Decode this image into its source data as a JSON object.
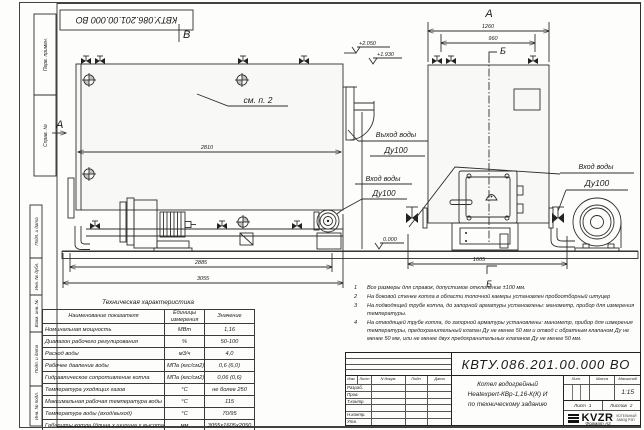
{
  "colors": {
    "line": "#2e2e2e",
    "paper": "#fdfdfc",
    "fill": "#f8f8f6"
  },
  "sheet": {
    "stamp_top": "КВТУ.086.201.00.000  ВО",
    "format_label": "Формат",
    "format_value": "А3",
    "margin": {
      "perv_primen": "Перв. примен.",
      "sprav_no": "Справ. №",
      "podp_data_1": "Подп. и дата",
      "inv_dubl": "Инв. № дубл.",
      "vzam_inv": "Взам. инв. №",
      "podp_data_2": "Подп. и дата",
      "inv_podl": "Инв. № подл."
    }
  },
  "views": {
    "side": {
      "label_b": "В",
      "label_a": "А",
      "see_note": "см. п. 2",
      "dim_width": "2810",
      "dim_frame": "2885",
      "dim_total": "3055",
      "outlet_line1": "Выход воды",
      "outlet_line2": "Ду100",
      "inlet_line1": "Вход воды",
      "inlet_line2": "Ду100"
    },
    "front": {
      "view_title": "А",
      "dim_total_width": "1260",
      "dim_valves": "960",
      "section_top": "Б",
      "section_bottom": "Б",
      "dim_base": "1605",
      "inlet_line1": "Вход воды",
      "inlet_line2": "Ду100"
    },
    "elevations": {
      "top": "+2.050",
      "mid": "+1.930",
      "zero": "0.000"
    }
  },
  "tech_table": {
    "title": "Техническая характеристика",
    "headers": [
      "Наименование показателя",
      "Единицы измерения",
      "Значение"
    ],
    "rows": [
      {
        "name": "Номинальная мощность",
        "unit": "МВт",
        "value": "1,16"
      },
      {
        "name": "Диапазон рабочего регулирования",
        "unit": "%",
        "value": "50-100"
      },
      {
        "name": "Расход воды",
        "unit": "м3/ч",
        "value": "4,0"
      },
      {
        "name": "Рабочее давление воды",
        "unit": "МПа (кгс/см2)",
        "value": "0,6 (6,0)"
      },
      {
        "name": "Гидравлическое сопротивление котла",
        "unit": "МПа (кгс/см2)",
        "value": "0,06 (0,6)"
      },
      {
        "name": "Температура уходящих газов",
        "unit": "°С",
        "value": "не более 250"
      },
      {
        "name": "Максимальная рабочая температура воды",
        "unit": "°С",
        "value": "115"
      },
      {
        "name": "Температура воды (вход/выход)",
        "unit": "°С",
        "value": "70/95"
      },
      {
        "name": "Габариты котла (длина х ширина х высота)",
        "unit": "мм",
        "value": "3055х1605х2050"
      }
    ]
  },
  "notes": {
    "items": [
      {
        "num": "1",
        "text": "Все размеры для справок, допустимое отклонение ±100 мм."
      },
      {
        "num": "2",
        "text": "На боковой стенке котла в области топочной камеры установлен пробоотборный штуцер"
      },
      {
        "num": "3",
        "text": "На подводящей трубе котла, до запорной арматуры установлены: манометр, прибор для измерения температуры."
      },
      {
        "num": "4",
        "text": "На отводящей трубе котла, до запорной арматуры установлены: манометр, прибор для измерения температуры, предохранительный клапан Ду не менее 50 мм и отвод с обратным клапаном Ду не менее 50 мм, или не менее двух предохранительных клапанов Ду не менее 50 мм."
      }
    ]
  },
  "title_block": {
    "doc_number": "КВТУ.086.201.00.000  ВО",
    "rev_headers": [
      "Изм.",
      "Лист",
      "N докум.",
      "Подп.",
      "Дата"
    ],
    "roles": [
      "Разраб.",
      "Пров.",
      "Т.контр.",
      "",
      "Н.контр.",
      "Утв."
    ],
    "product_line1": "Котел водогрейный",
    "product_line2": "Heatexpert-КВр-1,16-К(К) И",
    "product_line3": "по техническому заданию",
    "lit_label": "Лит.",
    "mass_label": "Масса",
    "scale_label": "Масштаб",
    "scale_value": "1:15",
    "sheet_label": "Лист",
    "sheet_value": "1",
    "sheets_label": "Листов",
    "sheets_value": "2",
    "logo_text": "KVZR",
    "logo_sub1": "КОТЕЛЬНЫЙ",
    "logo_sub2": "ЗАВОД РЭП"
  }
}
